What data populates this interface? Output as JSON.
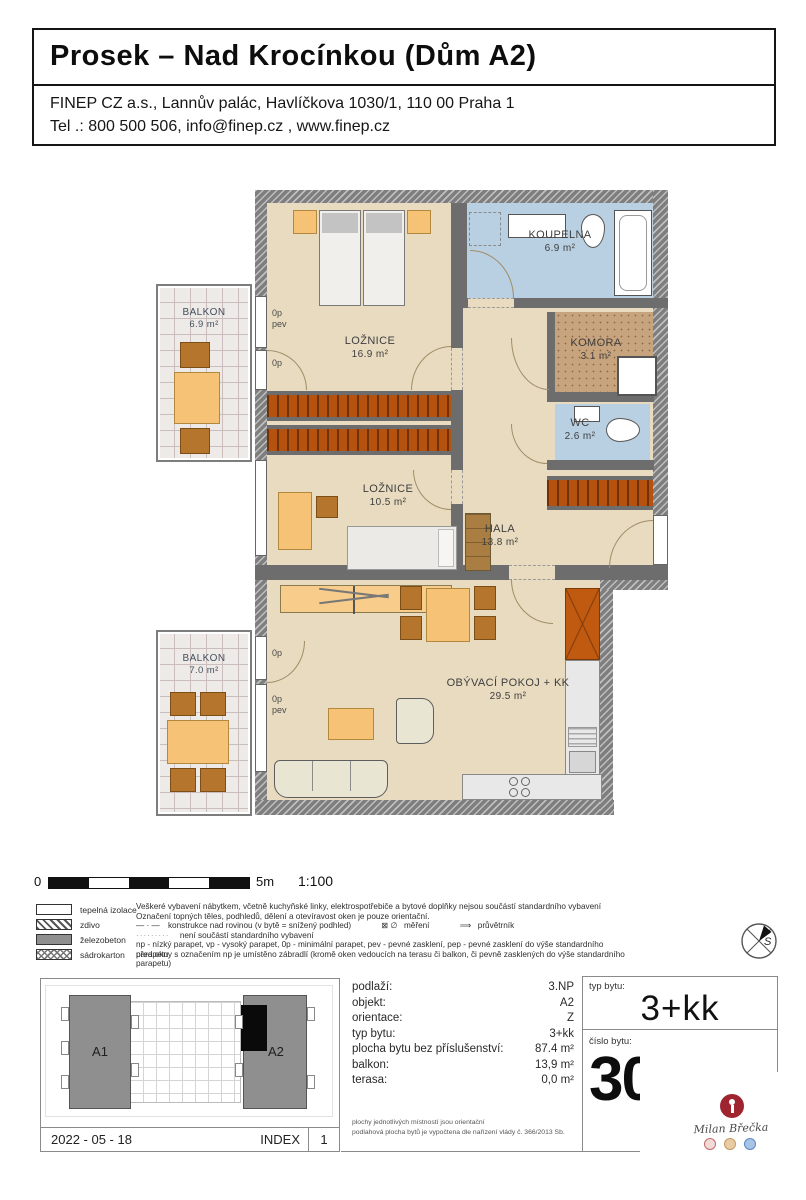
{
  "header": {
    "title": "Prosek – Nad Krocínkou (Dům A2)",
    "address_line1": "FINEP CZ a.s., Lannův palác, Havlíčkova 1030/1, 110 00  Praha 1",
    "address_line2": "Tel .: 800 500 506, info@finep.cz , www.finep.cz"
  },
  "plan": {
    "rooms": {
      "loznice1": {
        "name": "LOŽNICE",
        "area": "16.9 m²"
      },
      "koupelna": {
        "name": "KOUPELNA",
        "area": "6.9 m²"
      },
      "komora": {
        "name": "KOMORA",
        "area": "3.1 m²"
      },
      "wc": {
        "name": "WC",
        "area": "2.6 m²"
      },
      "loznice2": {
        "name": "LOŽNICE",
        "area": "10.5 m²"
      },
      "hala": {
        "name": "HALA",
        "area": "13.8 m²"
      },
      "obyvaci": {
        "name": "OBÝVACÍ POKOJ + KK",
        "area": "29.5 m²"
      },
      "balkon1": {
        "name": "BALKON",
        "area": "6.9 m²"
      },
      "balkon2": {
        "name": "BALKON",
        "area": "7.0 m²"
      }
    },
    "window_labels": {
      "w1a": "0p",
      "w1b": "pev",
      "w2": "0p",
      "w3": "0p",
      "w4a": "0p",
      "w4b": "pev"
    }
  },
  "scalebar": {
    "start": "0",
    "end": "5m",
    "ratio": "1:100"
  },
  "legend": {
    "items": [
      {
        "label": "tepelná izolace"
      },
      {
        "label": "zdivo"
      },
      {
        "label": "železobeton"
      },
      {
        "label": "sádrokarton"
      }
    ],
    "note1": "Veškeré vybavení nábytkem, včetně kuchyňské linky, elektrospotřebiče a bytové doplňky nejsou součástí standardního vybavení",
    "note2": "Označení topných těles, podhledů, dělení a otevíravost oken je pouze orientační.",
    "dashdot": "—  ·  —",
    "konstrukce": "konstrukce nad rovinou (v bytě = snížený podhled)",
    "mereni_sym": "⊠  ∅",
    "mereni": "měření",
    "pruvetrnik_sym": "⟹",
    "pruvetrnik": "průvětrník",
    "dots": "·········",
    "note4": "není součástí standardního vybavení",
    "note5": "np - nízký parapet, vp - vysoký parapet, 0p - minimální parapet, pev - pevné zasklení,  pep - pevné zasklení do výše standardního parapetu",
    "note6": "před okny s označením np je umístěno zábradlí (kromě oken vedoucích na terasu či balkon, či pevně zasklených do výše standardního parapetu)"
  },
  "compass": {
    "label": "S"
  },
  "siteplan": {
    "building_a1": "A1",
    "building_a2": "A2",
    "date": "2022 - 05 - 18",
    "index_label": "INDEX",
    "index_value": "1"
  },
  "info": {
    "rows": [
      {
        "label": "podlaží:",
        "value": "3.NP"
      },
      {
        "label": "objekt:",
        "value": "A2"
      },
      {
        "label": "orientace:",
        "value": "Z"
      },
      {
        "label": "typ bytu:",
        "value": "3+kk"
      },
      {
        "label": "plocha bytu bez příslušenství:",
        "value": "87.4 m²"
      },
      {
        "label": "balkon:",
        "value": "13,9 m²"
      },
      {
        "label": "terasa:",
        "value": "0,0 m²"
      }
    ],
    "fine1": "plochy jednotlivých místností jsou orientační",
    "fine2": "podlahová plocha bytů je vypočtena dle nařízení vlády č. 366/2013 Sb."
  },
  "unit": {
    "typ_label": "typ bytu:",
    "typ_value": "3+kk",
    "cislo_label": "číslo bytu:",
    "cislo_value": "30"
  },
  "logo": {
    "name": "Milan Břečka"
  }
}
